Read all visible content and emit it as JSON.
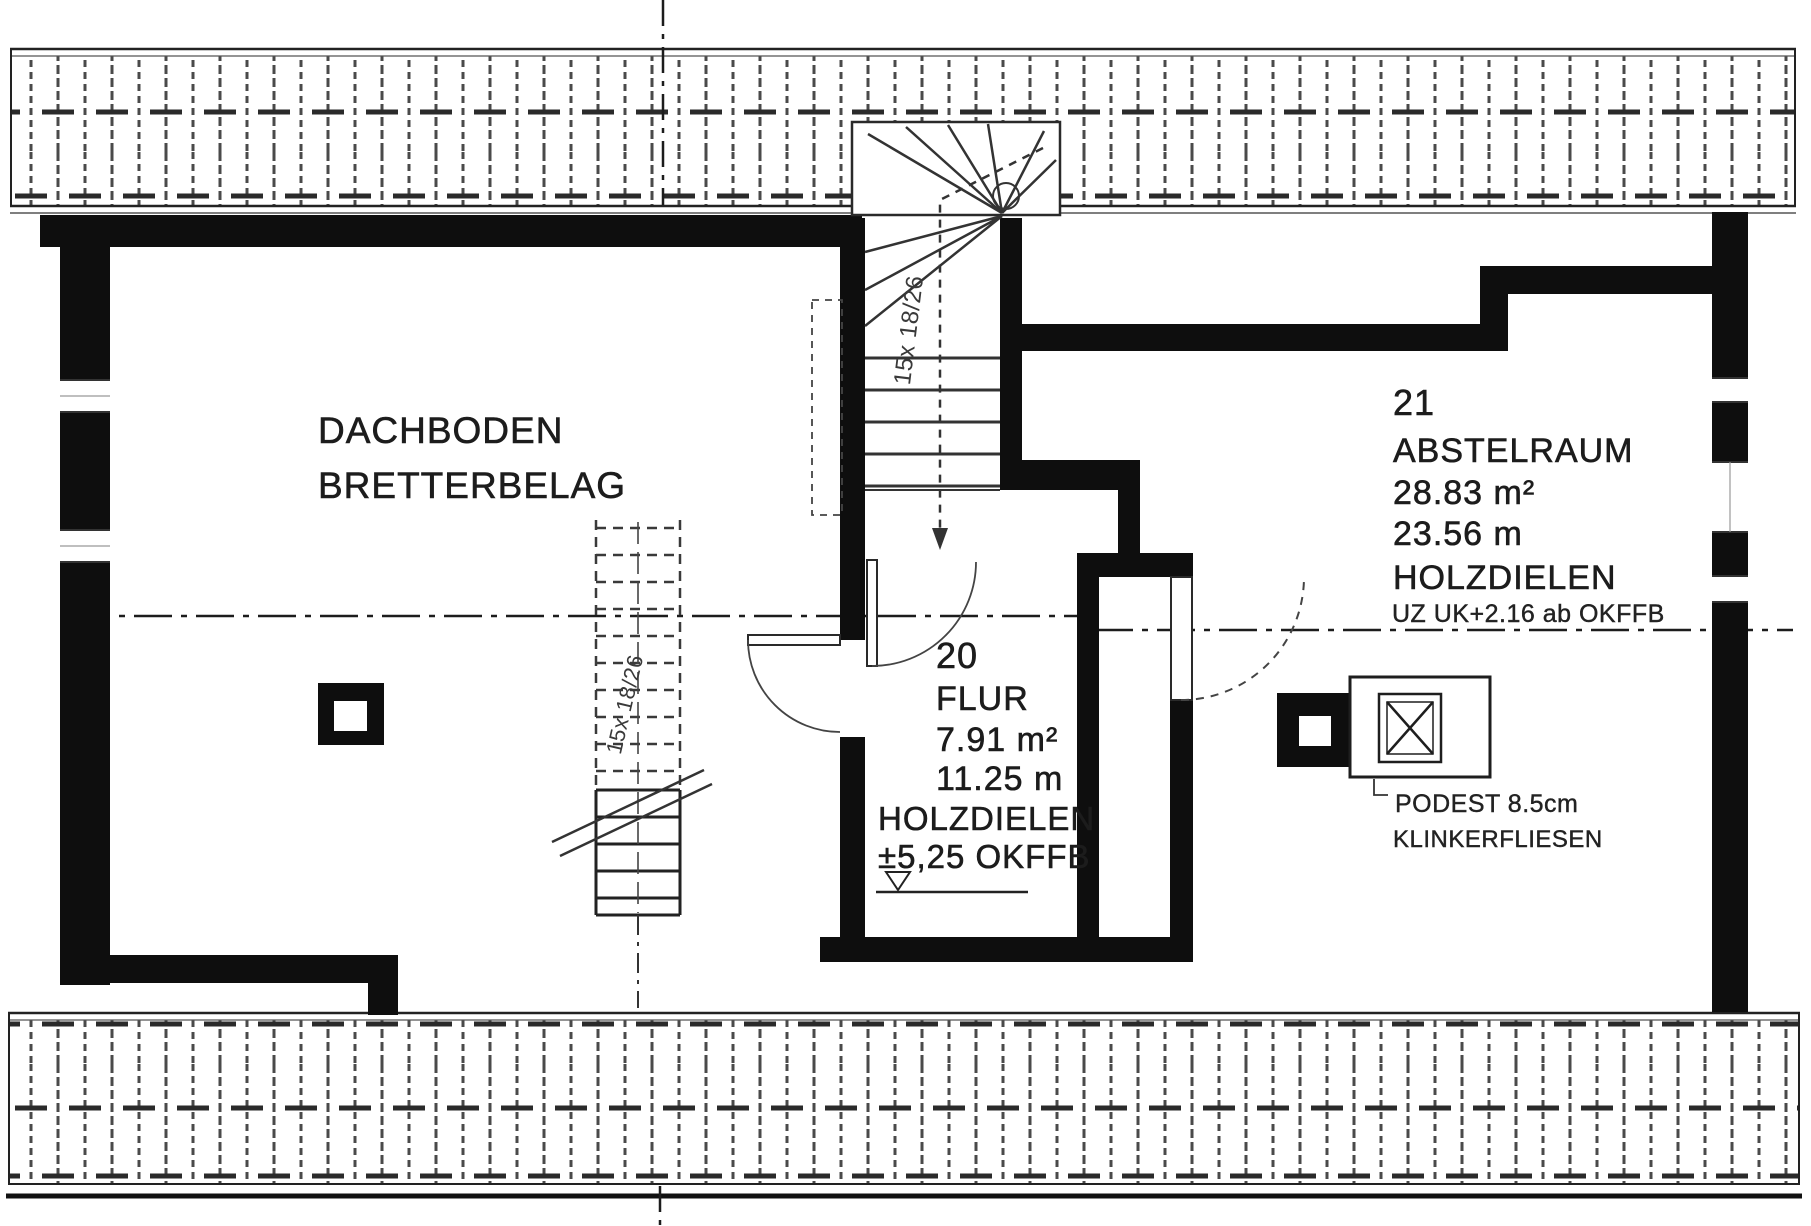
{
  "colors": {
    "ink": "#1c1c1c",
    "paper": "#ffffff"
  },
  "rooms": {
    "dachboden": {
      "name": "DACHBODEN",
      "floor": "BRETTERBELAG"
    },
    "flur": {
      "number": "20",
      "name": "FLUR",
      "area": "7.91 m²",
      "perimeter": "11.25 m",
      "floor": "HOLZDIELEN",
      "level": "±5,25 OKFFB"
    },
    "abstellraum": {
      "number": "21",
      "name": "ABSTELRAUM",
      "area": "28.83 m²",
      "perimeter": "23.56 m",
      "floor": "HOLZDIELEN",
      "beam_note": "UZ UK+2.16 ab OKFFB"
    }
  },
  "annotations": {
    "podest_title": "PODEST 8.5cm",
    "podest_material": "KLINKERFLIESEN",
    "stair_upper_label": "15x 18/26",
    "stair_lower_label": "15x 18/26"
  }
}
